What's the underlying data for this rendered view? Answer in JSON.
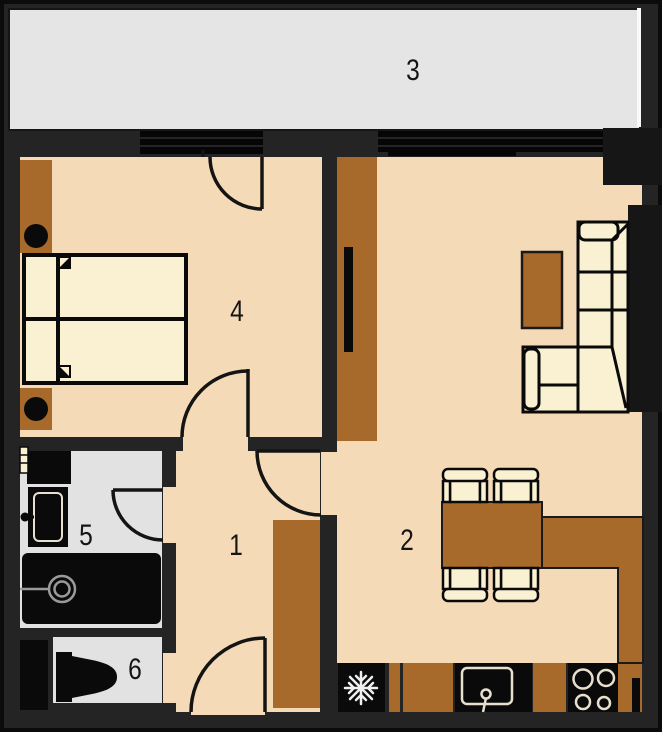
{
  "plan": {
    "title": "apartment-floor-plan",
    "rooms": [
      {
        "id": "hallway",
        "label": "1"
      },
      {
        "id": "living-kitchen",
        "label": "2"
      },
      {
        "id": "terrace",
        "label": "3"
      },
      {
        "id": "bedroom",
        "label": "4"
      },
      {
        "id": "bathroom",
        "label": "5"
      },
      {
        "id": "wc",
        "label": "6"
      }
    ],
    "colors": {
      "wall": "#242424",
      "fixture_black": "#0a0a0a",
      "floor": "#F5DAB8",
      "furniture_light": "#FAF1D3",
      "wood": "#A86A2B",
      "terrace_floor": "#E5E5E6",
      "wet_room_floor": "#E2E2E2"
    }
  }
}
